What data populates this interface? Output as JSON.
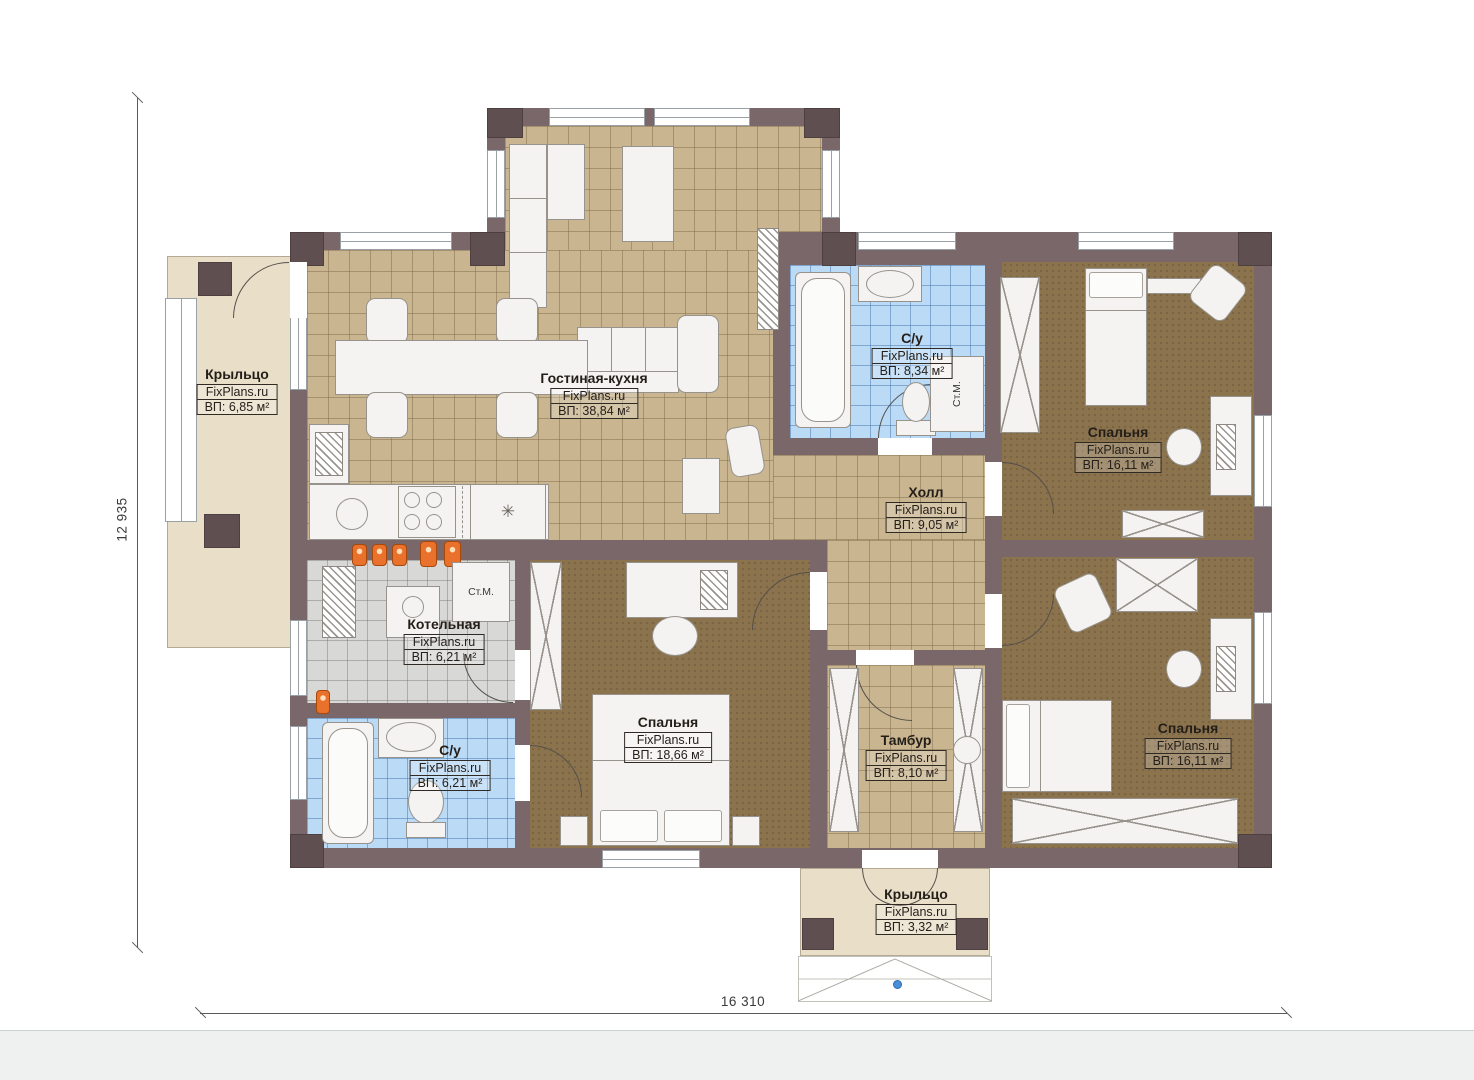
{
  "plan": {
    "watermark": "FixPlans.ru",
    "dimensions": {
      "width_label": "16 310",
      "height_label": "12 935"
    },
    "rooms": [
      {
        "id": "porch-left",
        "name": "Крыльцо",
        "area": "ВП: 6,85 м²"
      },
      {
        "id": "living-kitchen",
        "name": "Гостиная-кухня",
        "area": "ВП: 38,84 м²"
      },
      {
        "id": "bathroom-top",
        "name": "С/у",
        "area": "ВП: 8,34 м²"
      },
      {
        "id": "bedroom-top-right",
        "name": "Спальня",
        "area": "ВП: 16,11 м²"
      },
      {
        "id": "hall",
        "name": "Холл",
        "area": "ВП: 9,05 м²"
      },
      {
        "id": "boiler-room",
        "name": "Котельная",
        "area": "ВП: 6,21 м²"
      },
      {
        "id": "bathroom-bottom",
        "name": "С/у",
        "area": "ВП: 6,21 м²"
      },
      {
        "id": "bedroom-bottom-center",
        "name": "Спальня",
        "area": "ВП: 18,66 м²"
      },
      {
        "id": "vestibule",
        "name": "Тамбур",
        "area": "ВП: 8,10 м²"
      },
      {
        "id": "bedroom-bottom-right",
        "name": "Спальня",
        "area": "ВП: 16,11 м²"
      },
      {
        "id": "porch-bottom",
        "name": "Крыльцо",
        "area": "ВП: 3,32 м²"
      }
    ],
    "appliance_labels": {
      "washing_machine": "Ст.М."
    },
    "symbols": {
      "fridge": "✳"
    },
    "colors": {
      "wall": "#796769",
      "tile_tan": "#c9b590",
      "tile_blue": "#badaf5",
      "tile_gray": "#d8d8d6",
      "carpet_brown": "#8b734e",
      "porch_beige": "#e9dfc9",
      "radiator_orange": "#e9712b",
      "marker_blue": "#4a90d9"
    }
  }
}
